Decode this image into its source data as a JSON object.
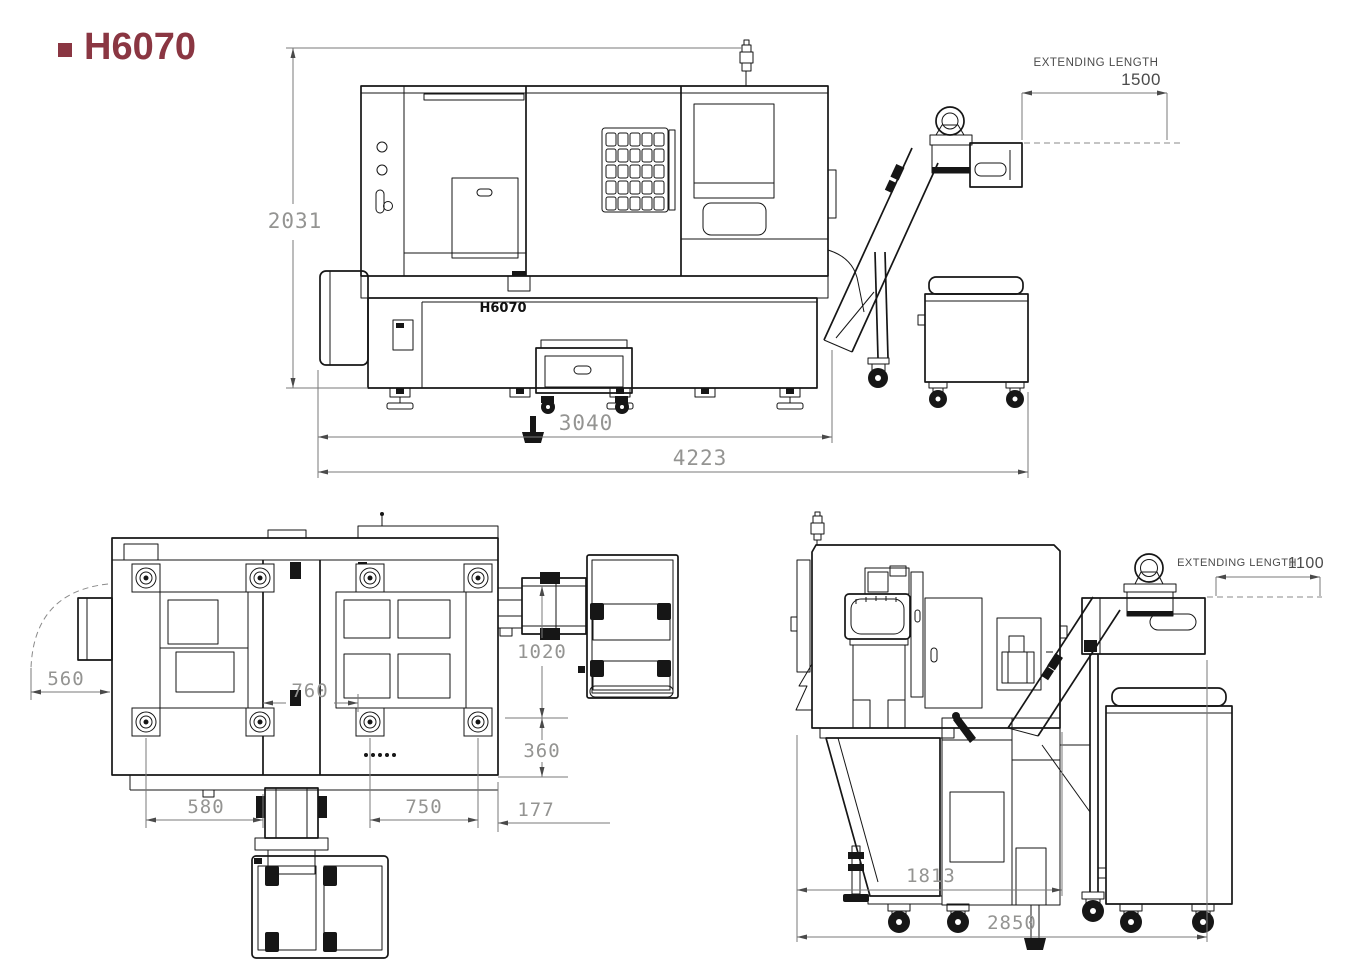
{
  "page": {
    "background": "#ffffff",
    "accent": "#8a3642",
    "line_color": "#161616",
    "dim_text_color": "#949492"
  },
  "title": {
    "text": "H6070"
  },
  "views": {
    "side": {
      "name": "side-elevation",
      "machine_label": "H6070",
      "dims": {
        "height": "2031",
        "base_length": "3040",
        "overall_length": "4223",
        "extending_label": "EXTENDING LENGTH",
        "extending_value": "1500"
      }
    },
    "plan": {
      "name": "plan-view",
      "dims": {
        "swing": "560",
        "center": "760",
        "depth_upper": "1020",
        "depth_lower": "360",
        "left_span": "580",
        "right_span": "750",
        "overhang": "177"
      }
    },
    "end": {
      "name": "end-elevation",
      "dims": {
        "extending_label": "EXTENDING LENGTH",
        "extending_value": "1100",
        "body_width": "1813",
        "overall_width": "2850"
      }
    }
  }
}
